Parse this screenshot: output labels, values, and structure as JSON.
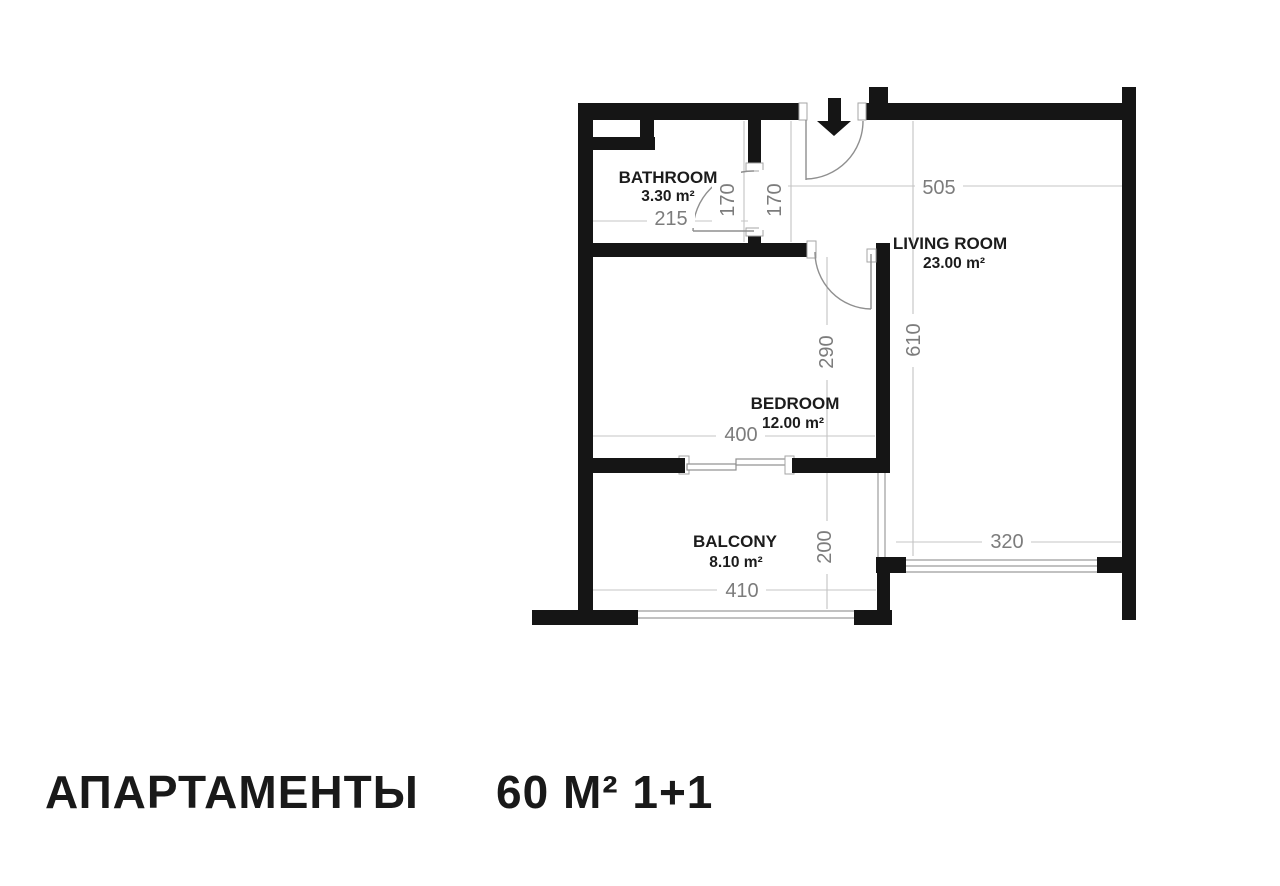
{
  "title": {
    "name": "АПАРТАМЕНТЫ",
    "spec": "60 М² 1+1"
  },
  "rooms": [
    {
      "name": "BATHROOM",
      "area": "3.30 m²"
    },
    {
      "name": "LIVING ROOM",
      "area": "23.00 m²"
    },
    {
      "name": "BEDROOM",
      "area": "12.00 m²"
    },
    {
      "name": "BALCONY",
      "area": "8.10 m²"
    }
  ],
  "dims": {
    "d505": "505",
    "d170a": "170",
    "d170b": "170",
    "d215": "215",
    "d290": "290",
    "d610": "610",
    "d400": "400",
    "d200": "200",
    "d410": "410",
    "d320": "320"
  },
  "icons": {
    "entrance_arrow": "down-arrow"
  },
  "colors": {
    "wall": "#151515",
    "dim_text": "#7c7c7c",
    "room_text": "#1c1c1c",
    "thin_line": "#c4c4c4",
    "glass_line": "#9c9c9c",
    "background": "#ffffff"
  }
}
